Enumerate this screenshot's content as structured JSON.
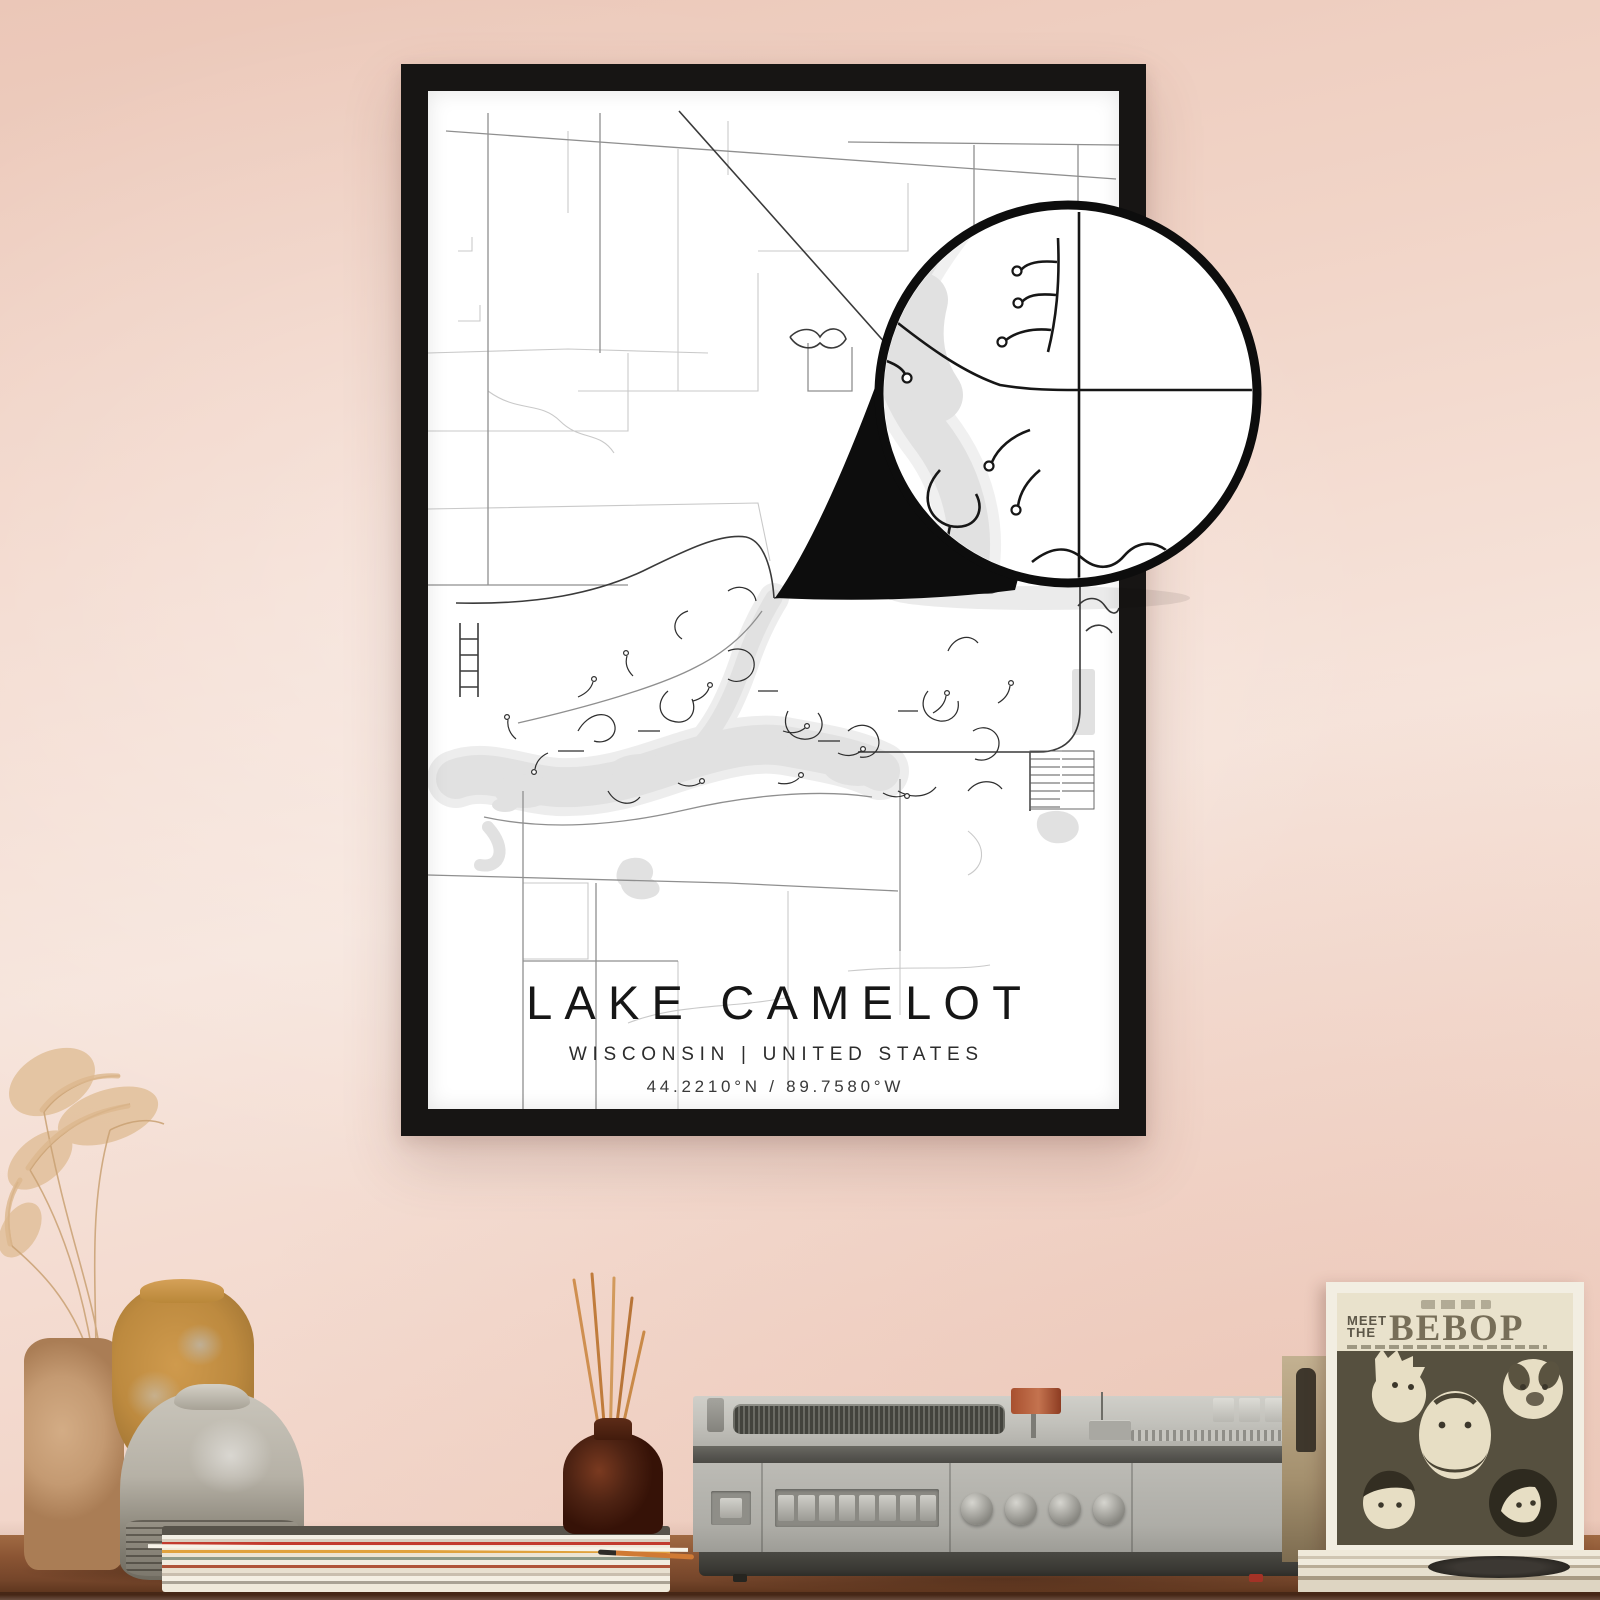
{
  "poster": {
    "title": "LAKE CAMELOT",
    "subtitle": "WISCONSIN | UNITED STATES",
    "coordinates": "44.2210°N / 89.7580°W"
  },
  "record_sleeve": {
    "pretitle_line1": "MEET",
    "pretitle_line2": "THE",
    "title": "BEBOP"
  },
  "colors": {
    "wall_pink": "#f1d4c7",
    "frame_black": "#171514",
    "map_water_gray": "#e1e1e1",
    "map_road_dark": "#333333",
    "magnifier_outline": "#0d0d0d",
    "shelf_wood_brown": "#8a5433",
    "sleeve_band_cream": "#e9e2cc",
    "sleeve_cover_sepia": "#56503f",
    "diffuser_brown": "#4e2313",
    "vase_orange": "#bd8a3f",
    "vase_tan": "#c49a72",
    "vase_gray": "#b6b1a6"
  }
}
